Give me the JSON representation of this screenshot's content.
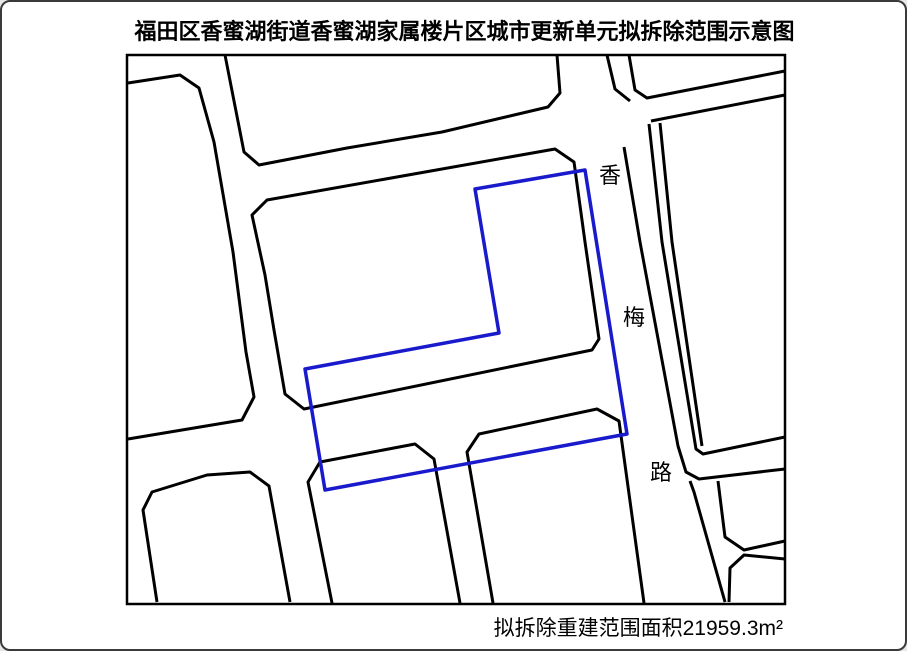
{
  "title": "福田区香蜜湖街道香蜜湖家属楼片区城市更新单元拟拆除范围示意图",
  "area_label": "拟拆除重建范围面积21959.3m²",
  "road_label": {
    "name": "香梅路",
    "chars": [
      {
        "ch": "香",
        "x": 608,
        "y": 181
      },
      {
        "ch": "梅",
        "x": 632,
        "y": 323
      },
      {
        "ch": "路",
        "x": 659,
        "y": 478
      }
    ]
  },
  "colors": {
    "outline": "#000000",
    "boundary": "#1a1acd",
    "background": "#ffffff"
  },
  "map": {
    "frame": {
      "x": 125,
      "y": 53,
      "w": 658,
      "h": 549
    },
    "polylines": [
      {
        "name": "block-north-top",
        "points": [
          [
            223,
            53
          ],
          [
            242,
            150
          ],
          [
            257,
            163
          ],
          [
            345,
            146
          ],
          [
            440,
            130
          ],
          [
            546,
            105
          ],
          [
            558,
            91
          ],
          [
            555,
            53
          ]
        ]
      },
      {
        "name": "block-left-large",
        "points": [
          [
            126,
            81
          ],
          [
            178,
            73
          ],
          [
            197,
            86
          ],
          [
            212,
            140
          ],
          [
            231,
            250
          ],
          [
            244,
            350
          ],
          [
            252,
            395
          ],
          [
            240,
            418
          ],
          [
            126,
            437
          ]
        ]
      },
      {
        "name": "block-central",
        "closed": true,
        "points": [
          [
            265,
            198
          ],
          [
            553,
            147
          ],
          [
            572,
            160
          ],
          [
            583,
            240
          ],
          [
            597,
            337
          ],
          [
            590,
            348
          ],
          [
            302,
            407
          ],
          [
            283,
            392
          ],
          [
            272,
            328
          ],
          [
            263,
            273
          ],
          [
            250,
            213
          ]
        ]
      },
      {
        "name": "block-northeast-outer-edge",
        "points": [
          [
            627,
            53
          ],
          [
            633,
            88
          ],
          [
            645,
            96
          ],
          [
            783,
            69
          ]
        ]
      },
      {
        "name": "block-northeast-inner-edge",
        "points": [
          [
            605,
            53
          ],
          [
            613,
            87
          ],
          [
            628,
            99
          ]
        ]
      },
      {
        "name": "road-northeast-south-edge",
        "points": [
          [
            649,
            119
          ],
          [
            783,
            93
          ]
        ]
      },
      {
        "name": "road-xiangmei-east-outer",
        "points": [
          [
            647,
            122
          ],
          [
            660,
            240
          ],
          [
            694,
            447
          ],
          [
            701,
            452
          ],
          [
            783,
            435
          ]
        ]
      },
      {
        "name": "road-xiangmei-east-inner",
        "points": [
          [
            658,
            121
          ],
          [
            670,
            240
          ],
          [
            700,
            444
          ]
        ]
      },
      {
        "name": "road-xiangmei-west-edge",
        "points": [
          [
            622,
            145
          ],
          [
            638,
            240
          ],
          [
            676,
            444
          ],
          [
            684,
            470
          ],
          [
            697,
            477
          ],
          [
            783,
            467
          ]
        ]
      },
      {
        "name": "road-southeast-west-edge",
        "points": [
          [
            688,
            479
          ],
          [
            692,
            490
          ],
          [
            723,
            600
          ]
        ]
      },
      {
        "name": "block-southeast-upper",
        "points": [
          [
            716,
            479
          ],
          [
            723,
            535
          ],
          [
            742,
            548
          ],
          [
            783,
            539
          ]
        ]
      },
      {
        "name": "block-southeast-lower",
        "points": [
          [
            727,
            600
          ],
          [
            728,
            566
          ],
          [
            742,
            553
          ],
          [
            783,
            557
          ]
        ]
      },
      {
        "name": "block-southwest",
        "points": [
          [
            155,
            600
          ],
          [
            141,
            508
          ],
          [
            150,
            490
          ],
          [
            205,
            473
          ],
          [
            248,
            470
          ],
          [
            267,
            484
          ],
          [
            288,
            600
          ]
        ]
      },
      {
        "name": "building-a",
        "points": [
          [
            330,
            601
          ],
          [
            306,
            480
          ],
          [
            318,
            460
          ],
          [
            413,
            442
          ],
          [
            432,
            457
          ],
          [
            458,
            601
          ]
        ]
      },
      {
        "name": "building-b",
        "points": [
          [
            491,
            601
          ],
          [
            465,
            450
          ],
          [
            477,
            432
          ],
          [
            595,
            407
          ],
          [
            617,
            419
          ],
          [
            642,
            601
          ]
        ]
      },
      {
        "name": "demolition-boundary",
        "closed": true,
        "color": "boundary",
        "width": 3.5,
        "points": [
          [
            473,
            187
          ],
          [
            583,
            168
          ],
          [
            625,
            432
          ],
          [
            323,
            488
          ],
          [
            303,
            367
          ],
          [
            497,
            331
          ]
        ]
      }
    ]
  }
}
